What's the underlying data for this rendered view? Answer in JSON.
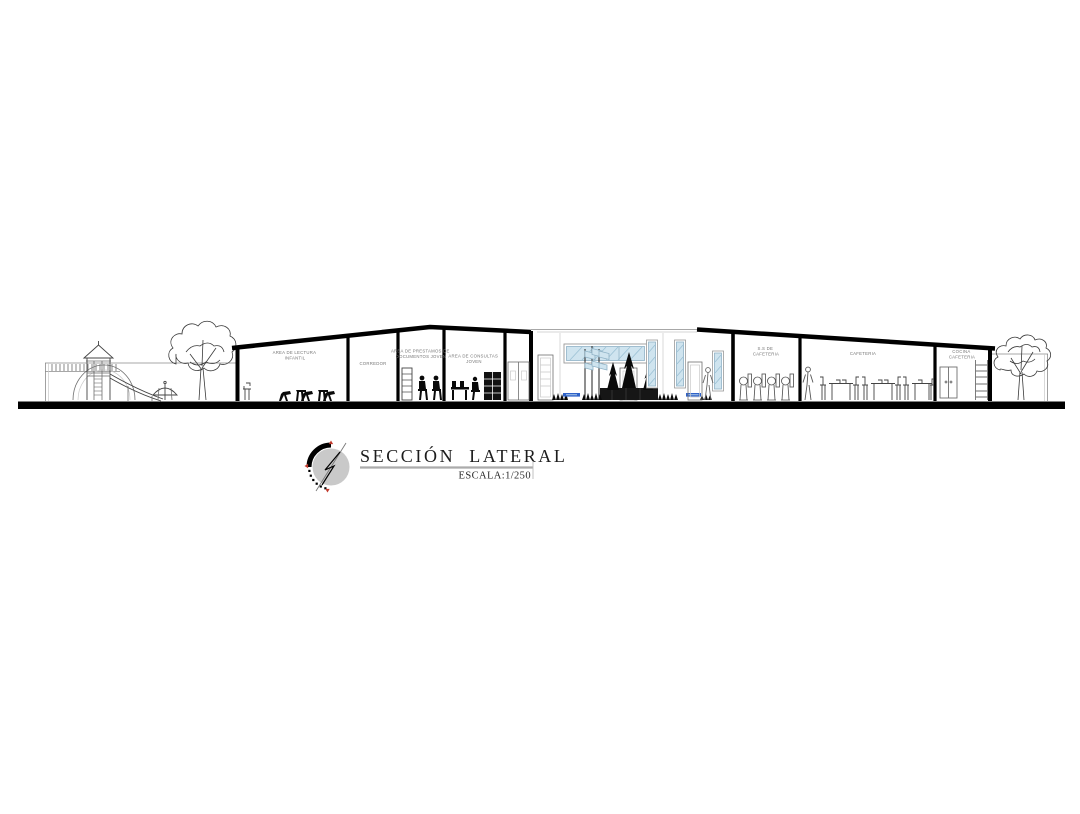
{
  "title_block": {
    "title": "SECCIÓN LATERAL",
    "scale_label": "ESCALA:1/250",
    "compass_icon": "north-arrow-compass-icon"
  },
  "room_labels": [
    {
      "line1": "AREA DE LECTURA",
      "line2": "INFANTIL"
    },
    {
      "line1": "CORREDOR",
      "line2": ""
    },
    {
      "line1": "AREA DE PRESTAMOS DE",
      "line2": "DOCUMENTOS JOVEN"
    },
    {
      "line1": "AREA DE CONSULTAS",
      "line2": "JOVEN"
    },
    {
      "line1": "S.S DE",
      "line2": "CAFETERIA"
    },
    {
      "line1": "CAFETERIA",
      "line2": ""
    },
    {
      "line1": "COCINA",
      "line2": "CAFETERIA"
    }
  ],
  "colors": {
    "ink": "#000000",
    "label_gray": "#767676",
    "glass_blue": "#cfe4ef",
    "glass_stroke": "#8fb2c6",
    "accent_blue": "#2e62c9",
    "compass_gray": "#c9c9c9",
    "compass_red": "#c23b2e"
  }
}
